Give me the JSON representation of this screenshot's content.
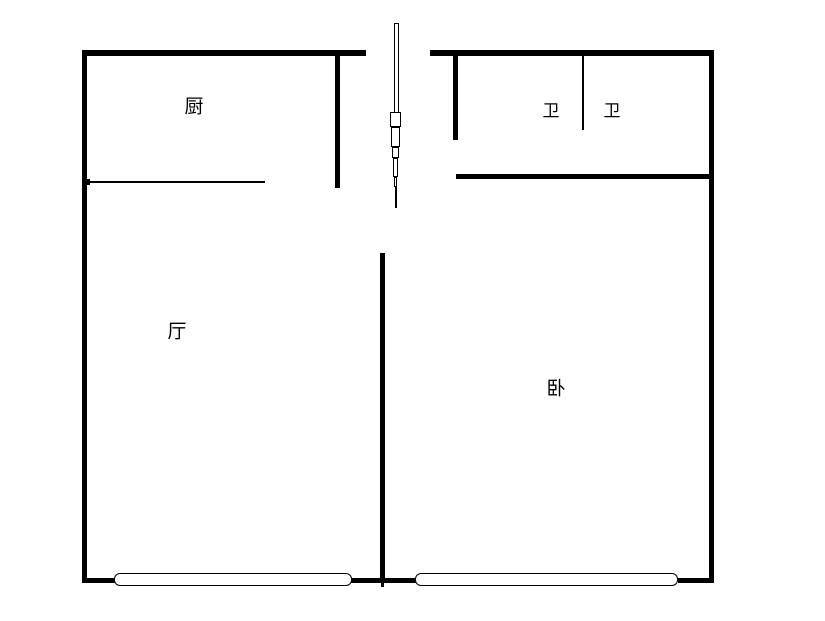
{
  "canvas": {
    "width": 825,
    "height": 621,
    "background": "#ffffff",
    "line_color": "#000000"
  },
  "rooms": [
    {
      "id": "kitchen",
      "label": "厨",
      "cx": 194,
      "cy": 107,
      "size": 19
    },
    {
      "id": "bathroom-left",
      "label": "卫",
      "cx": 551,
      "cy": 112,
      "size": 17
    },
    {
      "id": "bathroom-right",
      "label": "卫",
      "cx": 612,
      "cy": 112,
      "size": 17
    },
    {
      "id": "living-room",
      "label": "厅",
      "cx": 177,
      "cy": 332,
      "size": 19
    },
    {
      "id": "bedroom",
      "label": "卧",
      "cx": 556,
      "cy": 389,
      "size": 19
    }
  ],
  "walls": [
    {
      "id": "top-wall-left",
      "x": 82,
      "y": 50,
      "w": 284,
      "h": 6
    },
    {
      "id": "top-wall-right",
      "x": 430,
      "y": 50,
      "w": 284,
      "h": 6
    },
    {
      "id": "left-wall",
      "x": 82,
      "y": 50,
      "w": 5,
      "h": 533
    },
    {
      "id": "right-wall",
      "x": 709,
      "y": 50,
      "w": 5,
      "h": 533
    },
    {
      "id": "kitchen-partition",
      "x": 335,
      "y": 56,
      "w": 5,
      "h": 132
    },
    {
      "id": "bath-entry-partition",
      "x": 453,
      "y": 56,
      "w": 5,
      "h": 84
    },
    {
      "id": "bath-bottom-wall",
      "x": 456,
      "y": 174,
      "w": 258,
      "h": 5
    },
    {
      "id": "center-partition",
      "x": 380,
      "y": 253,
      "w": 5,
      "h": 330
    },
    {
      "id": "center-partition-tip",
      "x": 381,
      "y": 583,
      "w": 3,
      "h": 4
    },
    {
      "id": "bottom-wall-left",
      "x": 82,
      "y": 578,
      "w": 34,
      "h": 5
    },
    {
      "id": "bottom-wall-center",
      "x": 350,
      "y": 578,
      "w": 67,
      "h": 5
    },
    {
      "id": "bottom-wall-right",
      "x": 678,
      "y": 578,
      "w": 36,
      "h": 5
    }
  ],
  "thin_lines": [
    {
      "id": "kitchen-counter-line",
      "x": 86,
      "y": 181,
      "w": 179,
      "h": 2
    },
    {
      "id": "kitchen-counter-tick",
      "x": 85,
      "y": 179,
      "w": 5,
      "h": 6
    },
    {
      "id": "bath-divider-line",
      "x": 582,
      "y": 53,
      "w": 2,
      "h": 77
    }
  ],
  "windows": [
    {
      "id": "window-living-room",
      "x": 114,
      "y": 573,
      "w": 238,
      "h": 13
    },
    {
      "id": "window-bedroom",
      "x": 415,
      "y": 573,
      "w": 263,
      "h": 13
    }
  ],
  "entry_door_symbol": {
    "id": "entry-door-symbol",
    "segments": [
      {
        "x": 394,
        "y": 23,
        "w": 5,
        "h": 90,
        "type": "outline"
      },
      {
        "x": 390,
        "y": 112,
        "w": 11,
        "h": 15,
        "type": "outline"
      },
      {
        "x": 391,
        "y": 127,
        "w": 9,
        "h": 20,
        "type": "outline"
      },
      {
        "x": 392,
        "y": 147,
        "w": 7,
        "h": 11,
        "type": "outline"
      },
      {
        "x": 393,
        "y": 158,
        "w": 5,
        "h": 19,
        "type": "outline"
      },
      {
        "x": 394,
        "y": 177,
        "w": 3,
        "h": 10,
        "type": "outline"
      },
      {
        "x": 394.5,
        "y": 187,
        "w": 2,
        "h": 21,
        "type": "solid"
      }
    ]
  }
}
